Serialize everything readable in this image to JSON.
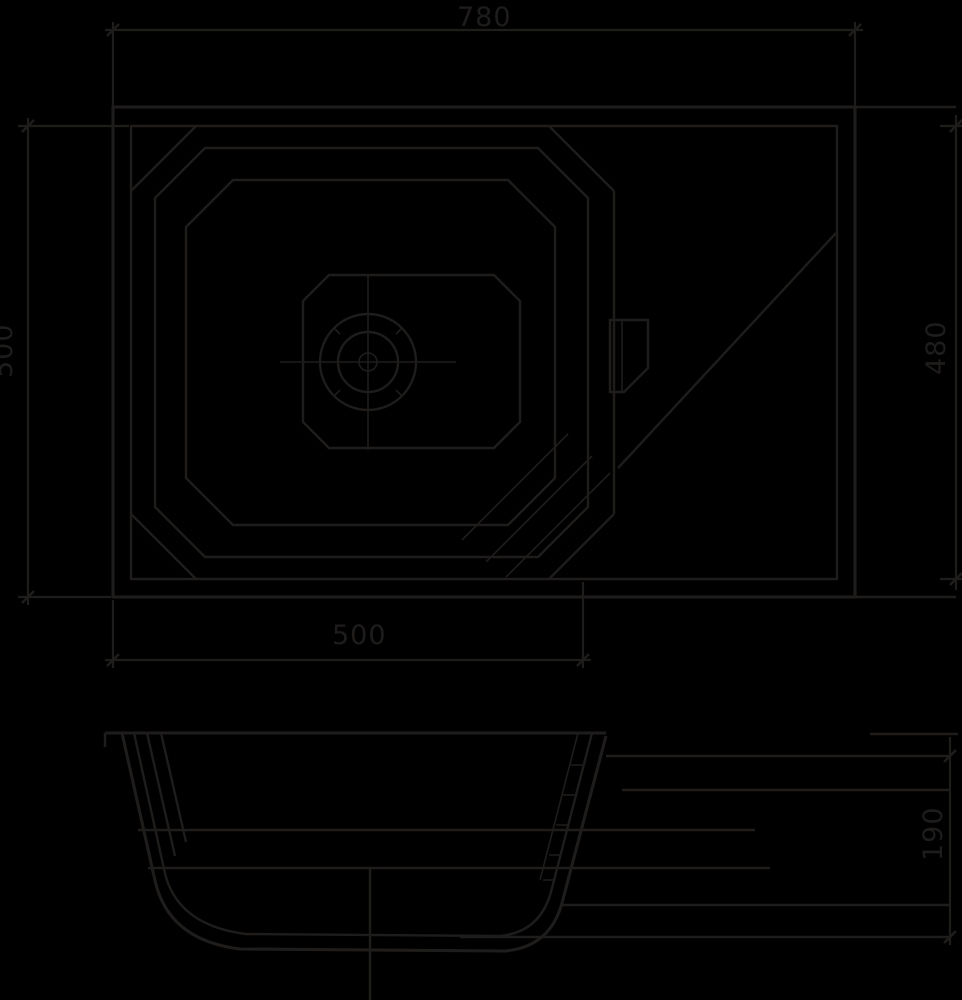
{
  "drawing": {
    "colors": {
      "background": "#000000",
      "line": "#1f1d1b"
    },
    "dims": {
      "overall_width": "780",
      "overall_depth_left": "500",
      "bowl_section_width": "500",
      "inner_depth_right": "480",
      "bowl_depth_section": "190"
    }
  }
}
